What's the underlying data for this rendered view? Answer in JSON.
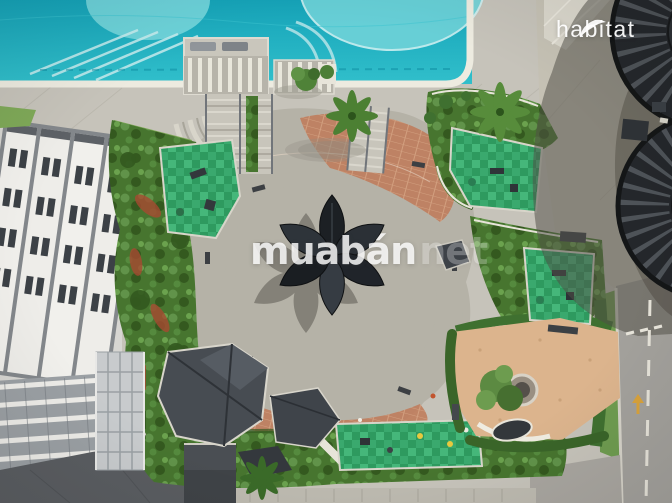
{
  "photo": {
    "description": "Aerial drone photograph of an apartment complex landscaped podium courtyard: swimming pool, central plaza with a dark flower-shaped canopy pavilion, green playgrounds, winding garden hedges, sand garden with tree, access road and round service towers",
    "regions": [
      {
        "name": "swimming-pool",
        "label": "Swimming pool"
      },
      {
        "name": "pool-deck",
        "label": "Pool deck"
      },
      {
        "name": "amphitheater-steps",
        "label": "Amphitheater steps"
      },
      {
        "name": "central-plaza",
        "label": "Central plaza"
      },
      {
        "name": "flower-canopy-pavilion",
        "label": "Flower-shaped canopy pavilion"
      },
      {
        "name": "playgrounds",
        "label": "Children playgrounds"
      },
      {
        "name": "garden-belts",
        "label": "Landscaped garden belts"
      },
      {
        "name": "apartment-building",
        "label": "Apartment building"
      },
      {
        "name": "glass-canopy-roofs",
        "label": "Faceted glass canopy roofs"
      },
      {
        "name": "sand-garden",
        "label": "Sand garden with tree"
      },
      {
        "name": "access-road",
        "label": "Access road"
      },
      {
        "name": "service-towers",
        "label": "Round ribbed service towers"
      }
    ]
  },
  "watermarks": {
    "center": {
      "text": "muabán",
      "suffix": "net",
      "color": "#ffffff"
    },
    "logo": {
      "text": "habitat",
      "icon": "leaf-icon",
      "color": "#ffffff"
    }
  },
  "palette": {
    "pool_water": "#1fb0c2",
    "pool_water_light": "#74d6db",
    "deck": "#c6c3ba",
    "plaza_cream": "#e8e2d4",
    "plaza_white": "#f2f0e9",
    "brick_paving": "#c07f5f",
    "greenery": "#4a7836",
    "playground_green": "#3aa96e",
    "building_white": "#f0efeb",
    "canopy_dark": "#22262b",
    "shadow": "#55524b",
    "sand": "#dcb48d",
    "road": "#a3a19c"
  }
}
